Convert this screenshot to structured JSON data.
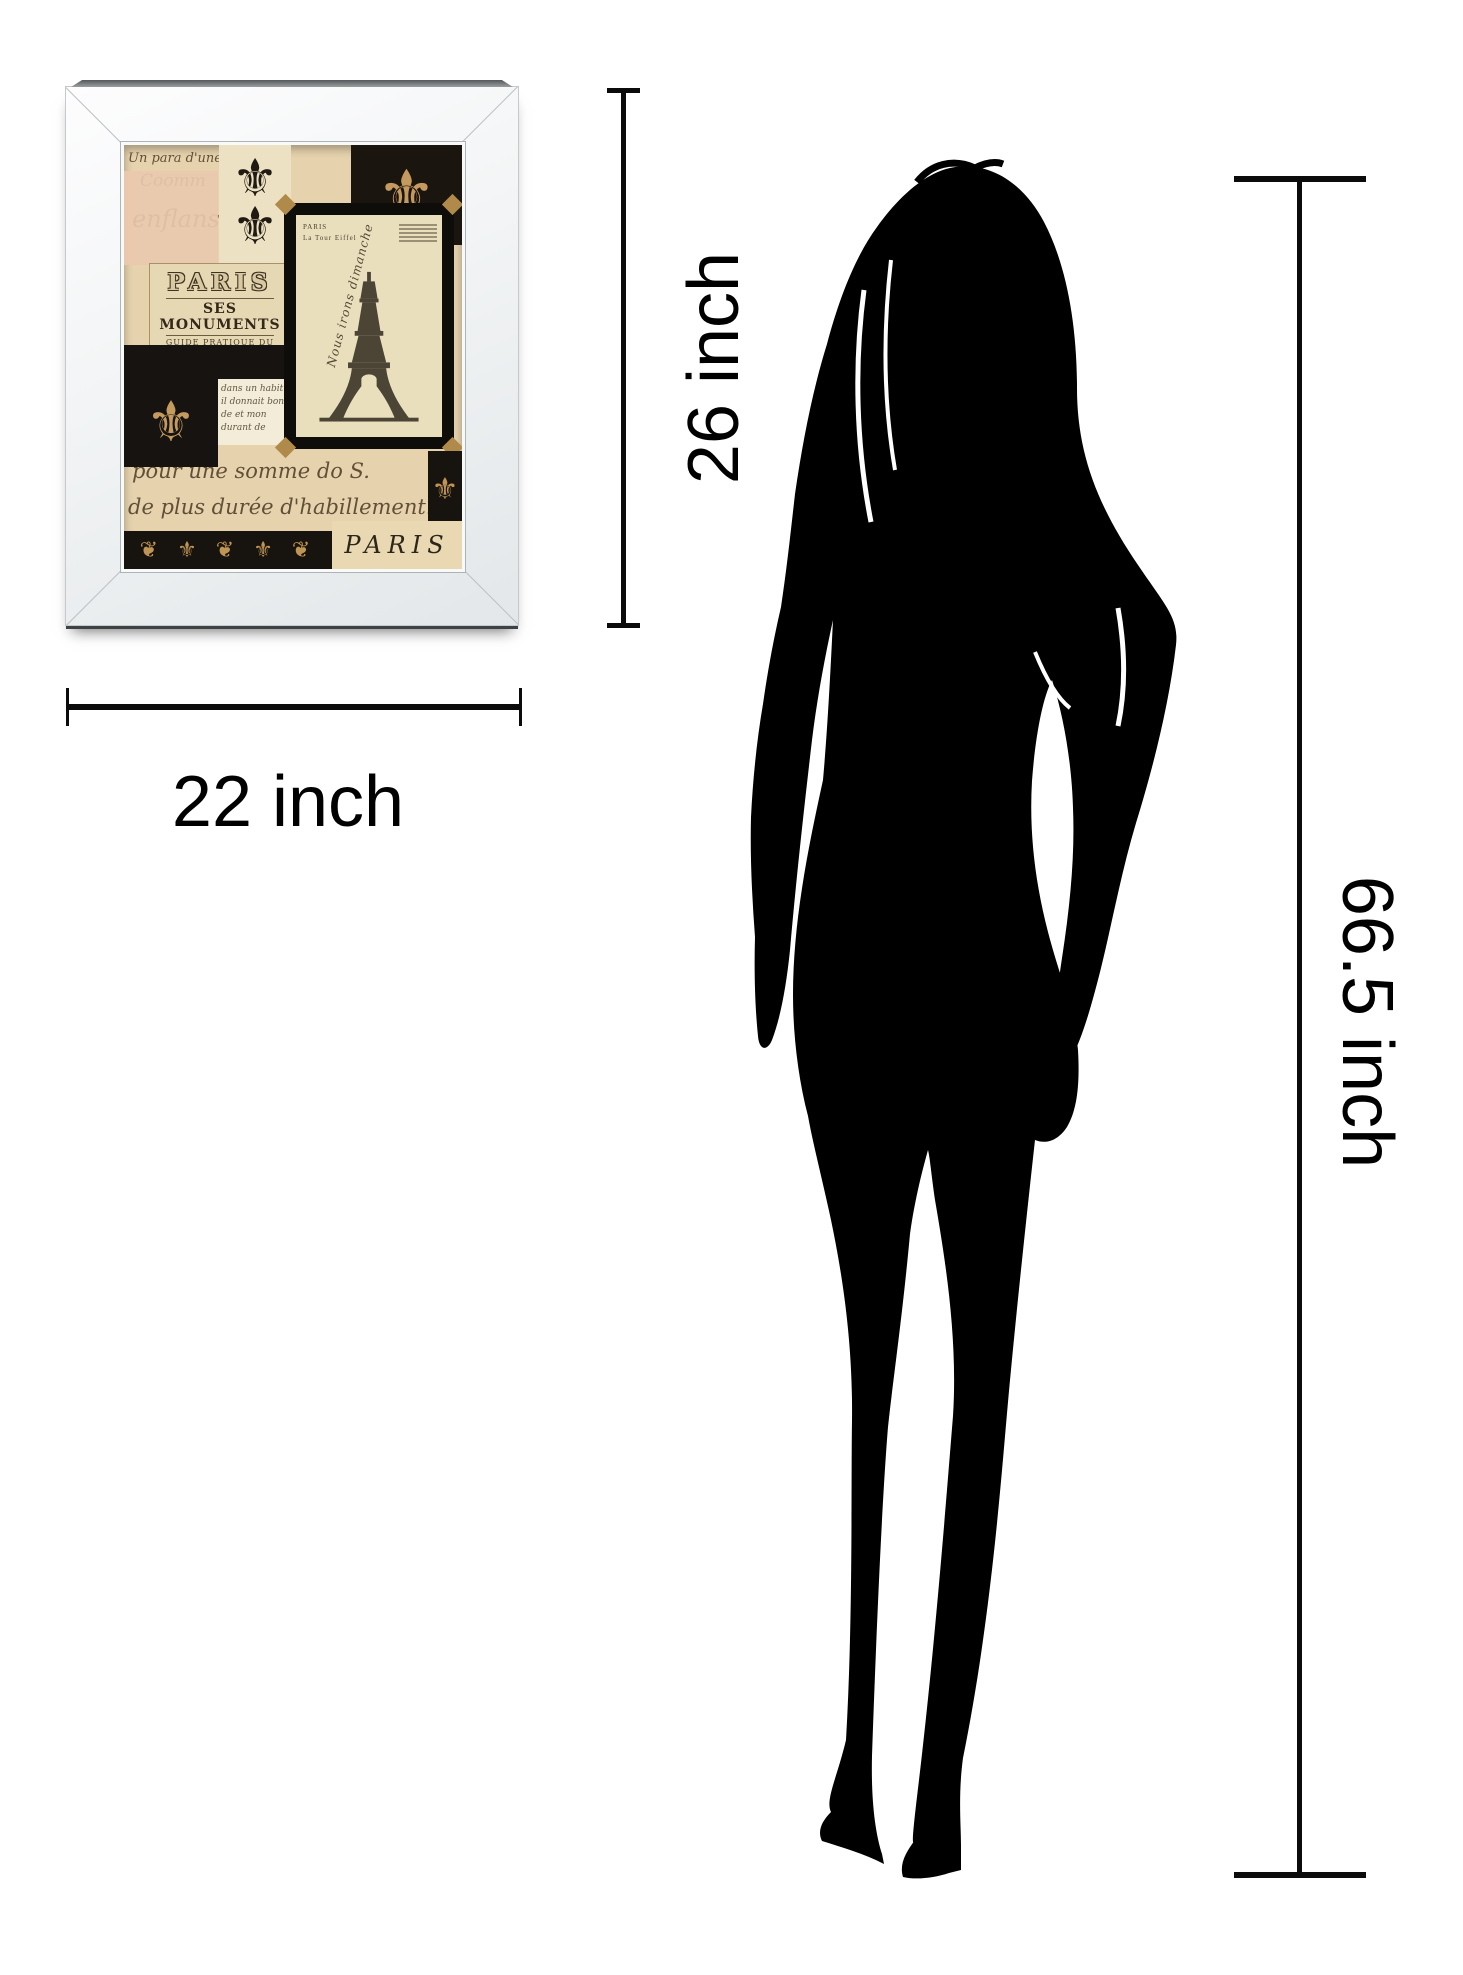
{
  "dimensions": {
    "frame_width": "22 inch",
    "frame_height": "26 inch",
    "person_height": "66.5 inch",
    "line_color": "#0b0b0b"
  },
  "artwork": {
    "sign": {
      "line1": "PARIS",
      "line2": "SES MONUMENTS",
      "line3": "GUIDE PRATIQUE DU VISITEUR",
      "line4": "Chemins de fer Métropolitains"
    },
    "postcard": {
      "header": "PARIS",
      "subheader": "La Tour Eiffel",
      "handwriting": "Nous irons dimanche"
    },
    "bottom_label": "PARIS",
    "script_fragments": [
      "Un para d'une au",
      "Coomm",
      "enflans",
      "dans un habit",
      "il donnait bon",
      "de et mon",
      "durant de",
      "pour une somme do S.",
      "de plus durée d'habillement."
    ],
    "ornament_glyph": "⚜",
    "ornament_row": "❦ ⚜ ❦ ⚜ ❦",
    "palette": {
      "paper": "#e6d2ad",
      "pink": "#eac9ae",
      "black": "#17130e",
      "gold": "#c59a5f",
      "frame_face": "#f1f3f4"
    }
  },
  "figure": {
    "color": "#000000"
  }
}
